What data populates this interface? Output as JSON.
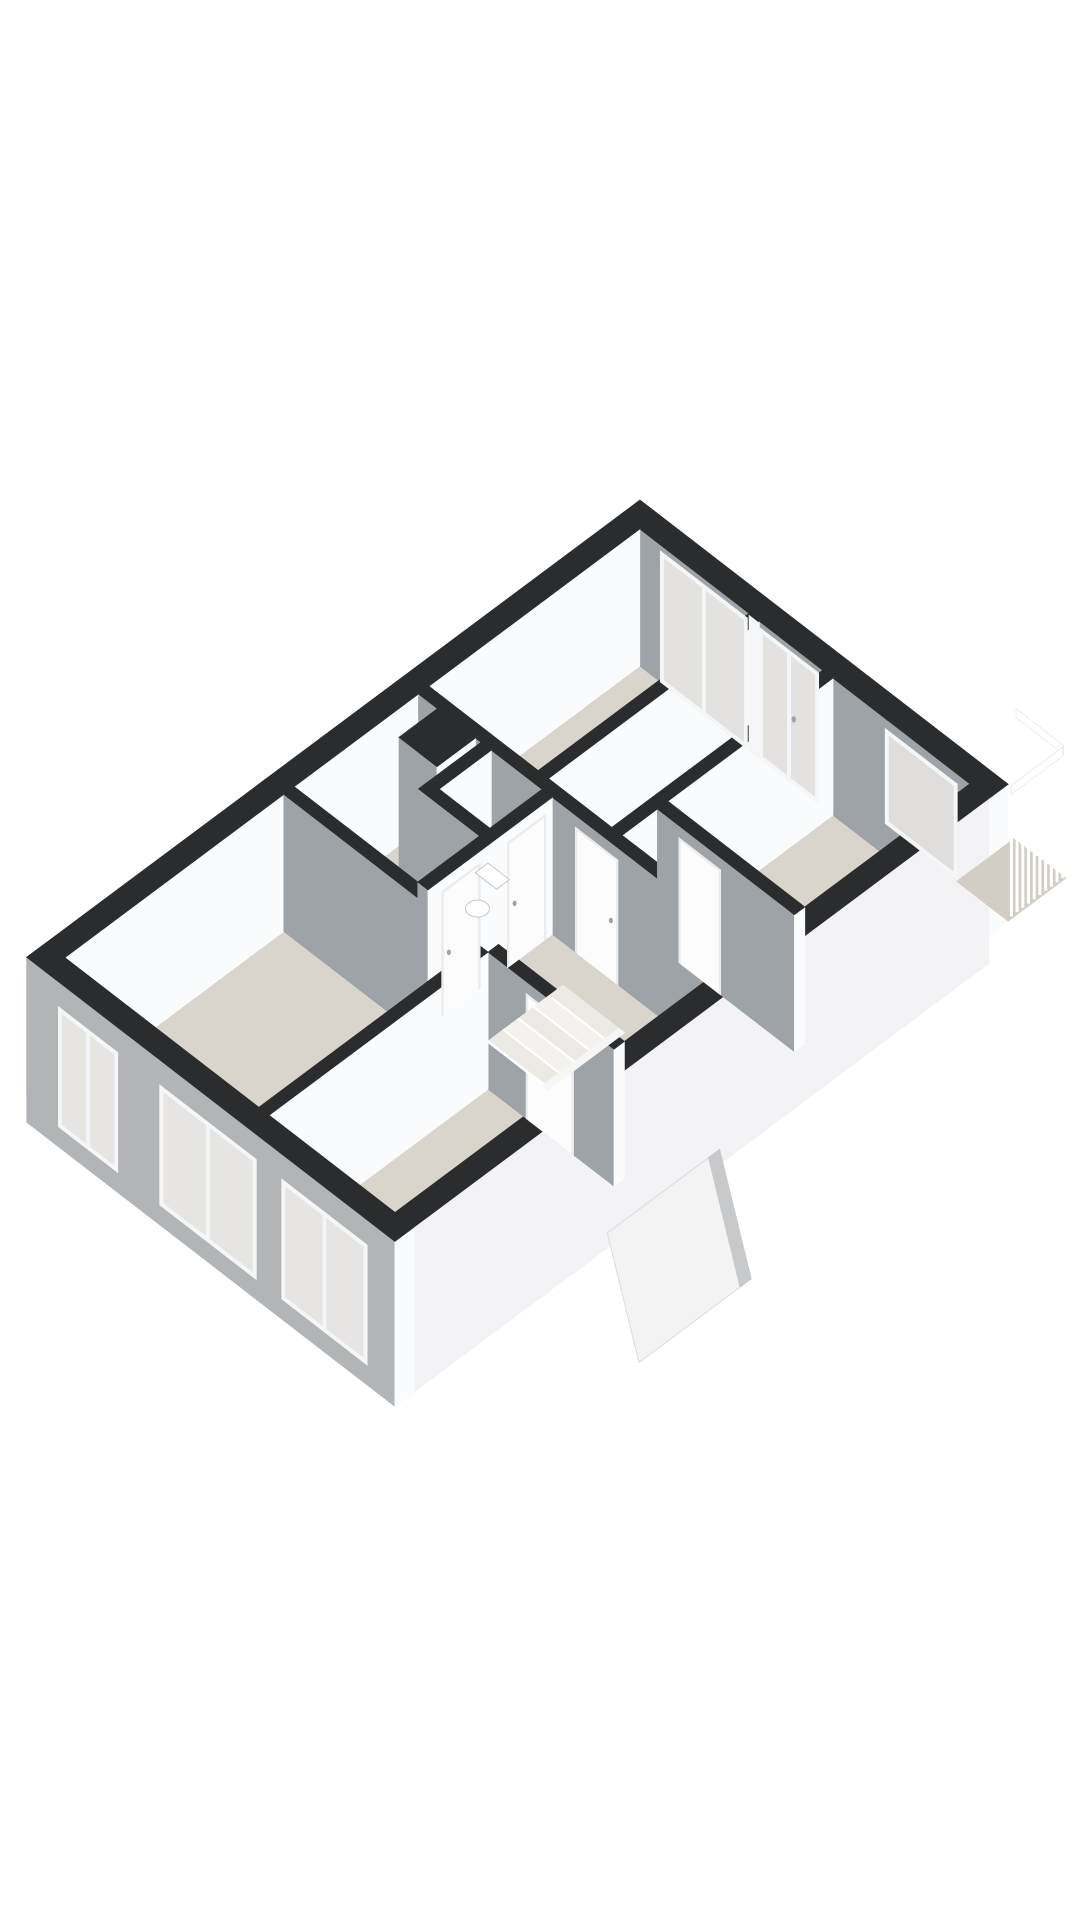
{
  "meta": {
    "description": "3d-isometric-floorplan",
    "canvas": {
      "width": 1080,
      "height": 1920
    }
  },
  "palette": {
    "background": "#ffffff",
    "wall_top": "#2b2c2e",
    "face_white": "#fafbfc",
    "face_gray": "#9ea3a7",
    "sw_outer_gray": "#b2b5b8",
    "se_outer_white": "#f3f3f5",
    "floor": "#d9d5cb",
    "balcony_floor": "#d2cec5",
    "glass": "#e3e2de",
    "glass_warm": "#dfdedb",
    "frame": "#f5f6f7",
    "door_panel": "#fcfcfd",
    "door_frame": "#ececee",
    "handle": "#a3a3a3",
    "tread": "#eceae5",
    "tread_alt": "#f3f2ef",
    "stringer": "#f6f6f7",
    "canopy": "#f3f3f4",
    "canopy_edge": "#c8c9cb",
    "toilet_fill": "#ffffff",
    "toilet_stroke": "#c8c8c8",
    "railing": "#ffffff"
  },
  "scene": {
    "projection": {
      "origin": [
        640,
        500
      ],
      "U": [
        0.7918,
        0.6111
      ],
      "V": [
        -0.8017,
        0.5977
      ],
      "wall_h": 137,
      "ext_h": 165
    },
    "floors": [
      {
        "name": "bedroom-left-floor",
        "rect": [
          24,
          162,
          24,
          287
        ]
      },
      {
        "name": "bedroom-mid-floor",
        "rect": [
          175,
          255,
          24,
          287
        ]
      },
      {
        "name": "bedroom-right-floor",
        "rect": [
          268,
          441,
          24,
          230
        ]
      },
      {
        "name": "corridor-north-floor",
        "rect": [
          255,
          441,
          243,
          287
        ]
      },
      {
        "name": "bath-wc-floor",
        "rect": [
          24,
          180,
          300,
          455
        ]
      },
      {
        "name": "hall-floor",
        "rect": [
          193,
          441,
          300,
          455
        ]
      },
      {
        "name": "living-room-floor",
        "rect": [
          24,
          269,
          468,
          741
        ]
      },
      {
        "name": "room-se-floor",
        "rect": [
          282,
          441,
          468,
          741
        ]
      }
    ],
    "walls": [
      {
        "name": "ne-exterior-wall",
        "rect": [
          0,
          465,
          0,
          24
        ]
      },
      {
        "name": "nw-exterior-wall",
        "rect": [
          0,
          24,
          24,
          765
        ]
      },
      {
        "name": "partition-bedrooms",
        "rect": [
          162,
          175,
          24,
          287
        ]
      },
      {
        "name": "partition-bedroom-right",
        "rect": [
          255,
          268,
          24,
          287
        ]
      },
      {
        "name": "cross-wall-mid",
        "rect": [
          24,
          441,
          287,
          300
        ]
      },
      {
        "name": "cross-wall-room-right",
        "rect": [
          268,
          441,
          230,
          243
        ]
      },
      {
        "name": "hall-west-wall",
        "rect": [
          180,
          193,
          300,
          455
        ]
      },
      {
        "name": "wc-south-wall",
        "rect": [
          103,
          180,
          365,
          378
        ]
      },
      {
        "name": "wc-west-wall",
        "rect": [
          103,
          116,
          300,
          365
        ]
      },
      {
        "name": "duct-shaft",
        "rect": [
          48,
          96,
          300,
          348
        ]
      },
      {
        "name": "living-north-wall",
        "rect": [
          24,
          282,
          455,
          468
        ]
      },
      {
        "name": "room-se-north-wall",
        "rect": [
          282,
          441,
          455,
          468
        ]
      },
      {
        "name": "room-se-west-wall",
        "rect": [
          269,
          282,
          468,
          741
        ]
      },
      {
        "name": "se-exterior-wall",
        "rect": [
          441,
          465,
          24,
          741
        ],
        "h": 165,
        "faceU": "#f3f3f5"
      },
      {
        "name": "sw-exterior-wall",
        "rect": [
          0,
          465,
          741,
          765
        ],
        "h": 165,
        "faceV": "#b2b5b8"
      }
    ],
    "endcaps": [
      {
        "name": "glass-mullion-wall-end",
        "plane": "v",
        "at": 24,
        "range": [
          162,
          175
        ],
        "z": [
          2,
          137
        ],
        "color": "#f5f6f7"
      }
    ],
    "openings": [
      {
        "name": "glass-door-left",
        "type": "glass",
        "plane": "v",
        "at": 24,
        "range": [
          50,
          160
        ],
        "z": [
          6,
          137
        ],
        "panes": 2,
        "glass": "#e3e2de"
      },
      {
        "name": "glass-door-right",
        "type": "glass",
        "plane": "v",
        "at": 24,
        "range": [
          175,
          250
        ],
        "z": [
          6,
          137
        ],
        "panes": 2,
        "glass": "#e3e2de",
        "handle": true
      },
      {
        "name": "bedroom-right-window",
        "type": "glass",
        "plane": "v",
        "at": 24,
        "range": [
          334,
          425
        ],
        "z": [
          10,
          105
        ],
        "panes": 1,
        "glass": "#dfdedb"
      },
      {
        "name": "sw-window-1",
        "type": "glass",
        "plane": "v",
        "at": 765,
        "range": [
          40,
          115
        ],
        "z": [
          25,
          145
        ],
        "panes": 2,
        "glass": "#e6e5e2"
      },
      {
        "name": "sw-window-2",
        "type": "glass",
        "plane": "v",
        "at": 765,
        "range": [
          168,
          290
        ],
        "z": [
          25,
          145
        ],
        "panes": 2,
        "glass": "#e6e5e2"
      },
      {
        "name": "sw-window-3",
        "type": "glass",
        "plane": "v",
        "at": 765,
        "range": [
          322,
          430
        ],
        "z": [
          25,
          145
        ],
        "panes": 2,
        "glass": "#e6e5e2"
      },
      {
        "name": "door-hall-north",
        "type": "door",
        "plane": "u",
        "at": 193,
        "range": [
          308,
          356
        ],
        "z": [
          12,
          137
        ],
        "handle": true
      },
      {
        "name": "door-hall-south",
        "type": "door",
        "plane": "u",
        "at": 193,
        "range": [
          390,
          438
        ],
        "z": [
          12,
          137
        ],
        "handle": true
      },
      {
        "name": "door-corridor",
        "type": "door",
        "plane": "v",
        "at": 300,
        "range": [
          222,
          276
        ],
        "z": [
          12,
          137
        ],
        "handle": true
      },
      {
        "name": "door-room-right",
        "type": "door",
        "plane": "v",
        "at": 243,
        "range": [
          295,
          348
        ],
        "z": [
          12,
          137
        ],
        "handle": false
      },
      {
        "name": "door-room-se",
        "type": "door",
        "plane": "v",
        "at": 468,
        "range": [
          330,
          390
        ],
        "z": [
          12,
          137
        ],
        "handle": false
      }
    ],
    "stairs": {
      "name": "staircase",
      "u": [
        242,
        312
      ],
      "v_start": 335,
      "tread_depth": 17,
      "gap": 2,
      "count": 5,
      "stringer": {
        "u": [
          312,
          320
        ],
        "v": [
          335,
          430
        ]
      }
    },
    "toilet": {
      "name": "toilet",
      "tank_rect": [
        128,
        155,
        316,
        332
      ],
      "tank_z": 96,
      "bowl_center": [
        141,
        342
      ],
      "bowl_z": 118,
      "rx": 12,
      "ry": 8.5
    },
    "canopy": {
      "name": "entry-canopy",
      "slab": [
        [
          465,
          360,
          150
        ],
        [
          465,
          500,
          150
        ],
        [
          505,
          500,
          255
        ],
        [
          505,
          360,
          255
        ]
      ],
      "edge": [
        [
          465,
          360,
          150
        ],
        [
          505,
          360,
          255
        ],
        [
          505,
          374,
          255
        ],
        [
          465,
          374,
          150
        ]
      ]
    },
    "balcony": {
      "name": "balcony",
      "floor_rect": [
        400,
        465,
        -72,
        0
      ],
      "runs": [
        {
          "name": "railing-run-ne",
          "fixed": "v",
          "at": -72,
          "range": [
            402,
            462
          ],
          "slats": 9
        },
        {
          "name": "railing-run-se",
          "fixed": "u",
          "at": 463,
          "range": [
            -70,
            -6
          ],
          "slats": 9
        }
      ],
      "slat_z": [
        16,
        137
      ],
      "rail_z": [
        6,
        15
      ]
    }
  }
}
